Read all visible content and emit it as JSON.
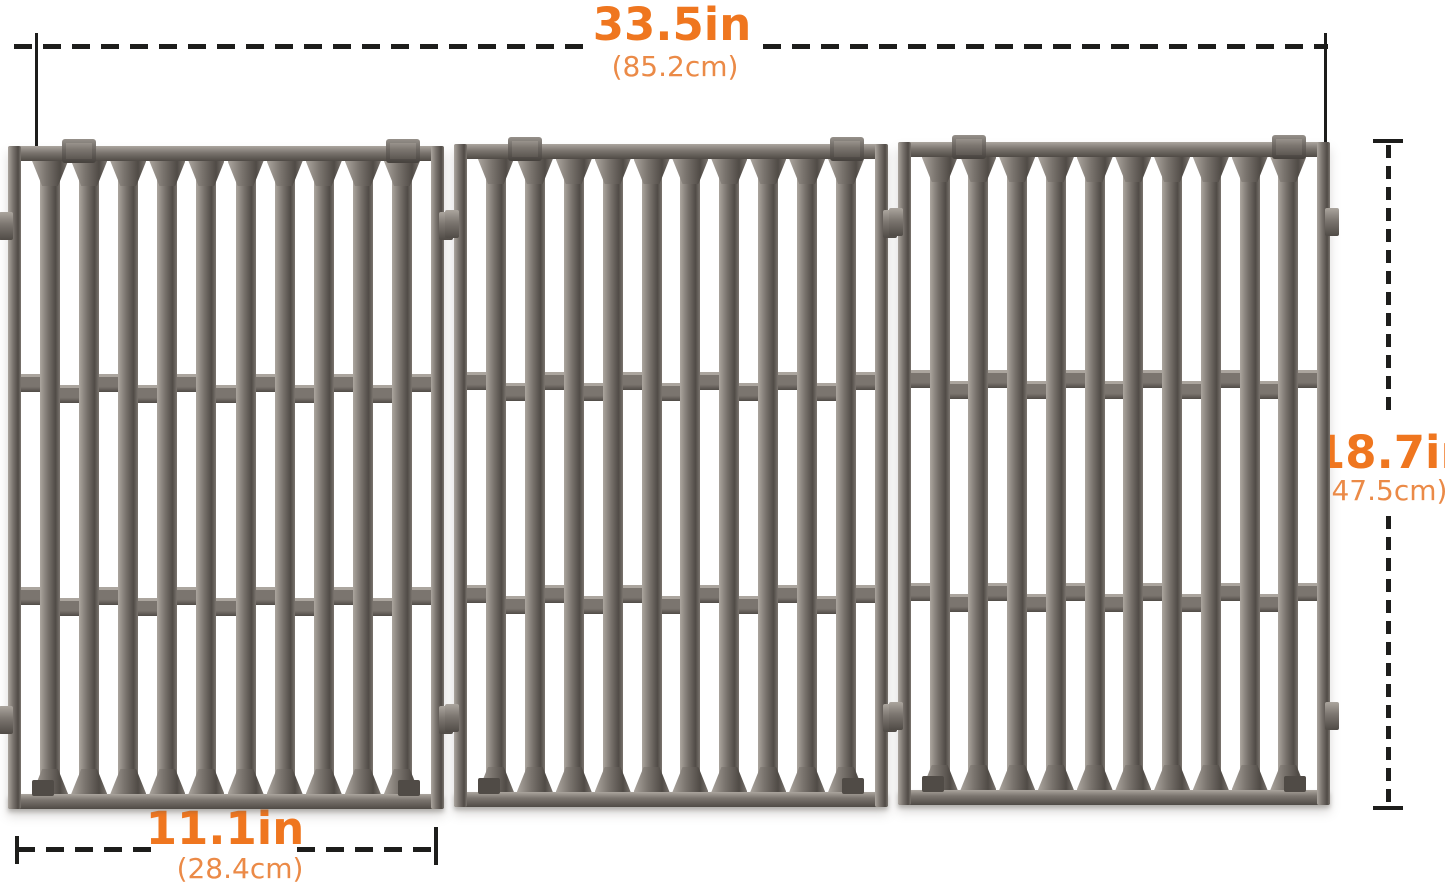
{
  "title": "grill-cooking-grates-dimension-diagram",
  "dimensions": {
    "overall_width": {
      "in": "33.5in",
      "cm": "(85.2cm)"
    },
    "overall_depth": {
      "in": "18.7in",
      "cm": "(47.5cm)"
    },
    "panel_width": {
      "in": "11.1in",
      "cm": "(28.4cm)"
    }
  },
  "colors": {
    "accent": "#ef761f",
    "accent_light": "#eb8a47",
    "line": "#1d1d1b",
    "background": "#ffffff",
    "metal_light": "#aba59e",
    "metal_base": "#7b756f",
    "metal_dark": "#504b46"
  },
  "graphic": {
    "name": "cast-iron-grill-grates",
    "panels": 3,
    "bars_per_panel": 10,
    "cross_rib_rows": 2
  }
}
